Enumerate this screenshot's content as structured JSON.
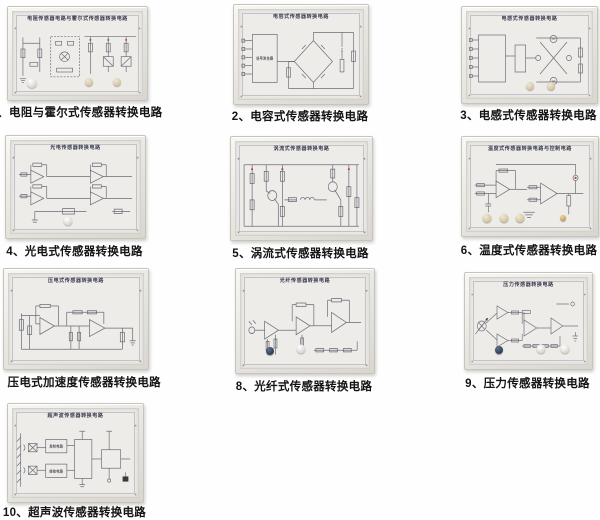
{
  "page": {
    "background": "#ffffff",
    "board_face_color": "#edece8",
    "board_frame_color": "#e6e4df",
    "schematic_line_color": "#6b6b78",
    "caption_color": "#141414",
    "accent_red": "#a94442",
    "knob_colors": {
      "white": "#ddd9d2",
      "beige": "#d8caab",
      "dark_blue": "#2d3d53",
      "gold": "#c9a86a"
    }
  },
  "panels": [
    {
      "num": "1",
      "title": "电阻传感器电路与霍尔式传感器转换电路",
      "caption": "1、电阻与霍尔式传感器转换电路"
    },
    {
      "num": "2",
      "title": "电容式传感器转换电路",
      "caption": "2、电容式传感器转换电路",
      "block_label": "信号发生器"
    },
    {
      "num": "3",
      "title": "电感式传感器转换电路",
      "caption": "3、电感式传感器转换电路"
    },
    {
      "num": "4",
      "title": "光电传感器转换电路",
      "caption": "4、光电式传感器转换电路"
    },
    {
      "num": "5",
      "title": "涡流式传感器转换电路",
      "caption": "5、涡流式传感器转换电路"
    },
    {
      "num": "6",
      "title": "温度式传感器转换电路与控制电路",
      "caption": "6、温度式传感器转换电路"
    },
    {
      "num": "7",
      "title": "压电式传感器转换电路",
      "caption": "7、压电式加速度传感器转换电路"
    },
    {
      "num": "8",
      "title": "光纤传感器转换电路",
      "caption": "8、光纤式传感器转换电路"
    },
    {
      "num": "9",
      "title": "压力传感器转换电路",
      "caption": "9、压力传感器转换电路"
    },
    {
      "num": "10",
      "title": "超声波传感器转换电路",
      "caption": "10、超声波传感器转换电路",
      "block_labels": {
        "transmit": "发射电路",
        "receive": "接收电路"
      }
    }
  ]
}
